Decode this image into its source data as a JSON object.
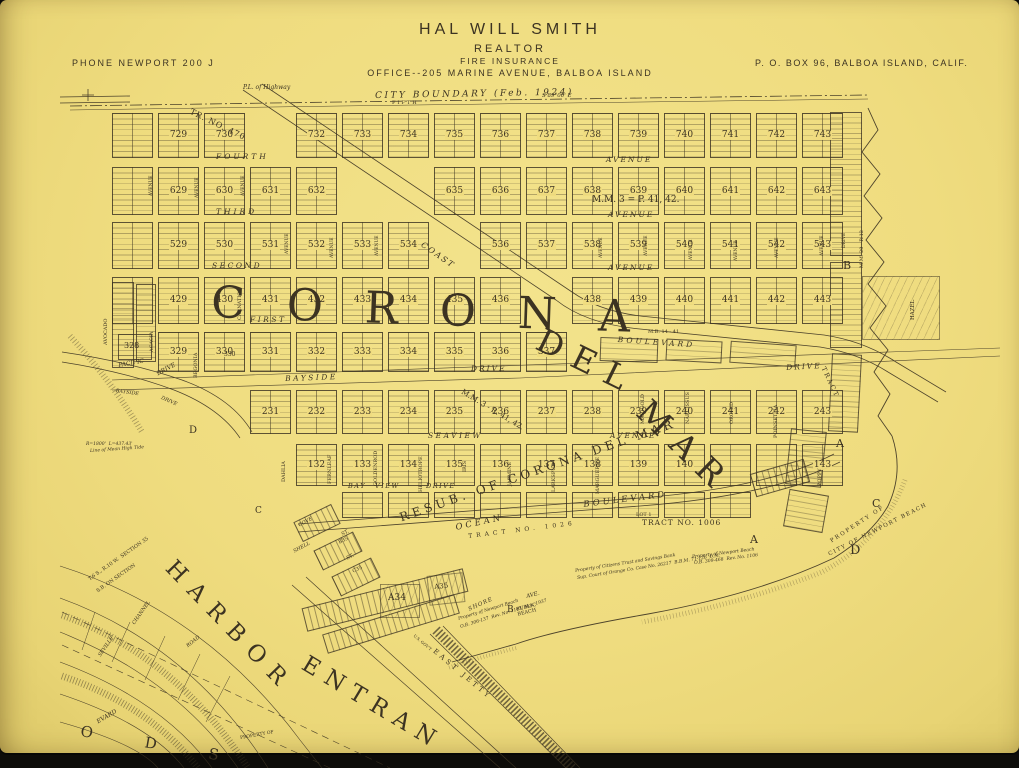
{
  "colors": {
    "paper": "#efdc7f",
    "ink": "#3c3322"
  },
  "header": {
    "title": "HAL WILL SMITH",
    "subtitle": "REALTOR",
    "line3": "FIRE INSURANCE",
    "office": "OFFICE--205 MARINE AVENUE, BALBOA ISLAND",
    "phone": "PHONE NEWPORT 200 J",
    "po_box": "P. O. BOX 96, BALBOA ISLAND, CALIF."
  },
  "map": {
    "boundary": {
      "city_boundary": "CITY BOUNDARY (Feb. 1924)",
      "bearing": "S 89°00' E",
      "highway_note": "P.L. of Highway",
      "fifth": "FIFTH"
    },
    "big": {
      "corona": "CORONA",
      "del": "DEL",
      "mar": "MAR",
      "harbor": "HARBOR",
      "entrance": "ENTRAN",
      "resub": "RESUB. OF CORONA DEL MAR",
      "ods": "O D S"
    },
    "streets": {
      "fourth": "FOURTH",
      "third": "THIRD",
      "second": "SECOND",
      "first": "FIRST",
      "avenue": "AVENUE",
      "bayside": "BAYSIDE",
      "drive": "DRIVE",
      "seaview": "SEAVIEW",
      "bay": "BAY",
      "view": "VIEW",
      "ocean": "OCEAN",
      "boulevard": "BOULEVARD",
      "coast": "COAST",
      "pacific": "PACIFIC",
      "shore": "SHORE",
      "ave": "AVE.",
      "cove": "COVE",
      "st": "ST.",
      "shell": "SHELL",
      "channel": "CHANNEL",
      "road": "ROAD",
      "seville": "SEVILLE",
      "boulevard_frag": "EVARD",
      "east_jetty": "EAST JETTY",
      "vertical": [
        "AVOCADO",
        "ACACIA",
        "BEGONIA",
        "CARNATION",
        "DAHLIA",
        "FERNLEAF",
        "GOLDENROD",
        "HELIOTROPE",
        "IRIS",
        "JASMINE",
        "LARKSPUR",
        "MARGUERITE",
        "MARIGOLD",
        "NARCISSUS",
        "ORCHID",
        "POINSETTIA",
        "POPPY",
        "HAZEL"
      ]
    },
    "tracts": {
      "tr470": "TR. NO. 470",
      "mm3p": "M.M. 3 = P. 41, 42.",
      "mm3r": "M.M. 3 - R. 41, 42.",
      "lot1": "LOT 1",
      "tract1006": "TRACT NO. 1006",
      "tract1026": "TRACT NO. 1026",
      "mm20r12": "M.M. 20 - R.12",
      "tract_frag": "TRACT",
      "mb14": "M.B. 14 - 41"
    },
    "annotations": {
      "public_beach": "PUBLIC BEACH",
      "prop_nb1": "Property of Newport Beach",
      "prop_nb1b": "O.B. 306-137  Rev. No. 1163  Nov. 1937",
      "prop_cit1": "Property of Citizens Trust and Savings Bank",
      "prop_cit2": "Sup. Court of Orange Co. Case No. 26217  B.B.M. 71-126  D.M.",
      "prop_nb2": "Property of Newport Beach",
      "prop_nb2b": "O.B. 309-468  Rev. No. 1106",
      "property_of": "PROPERTY OF",
      "city_of_nb": "CITY OF NEWPORT BEACH",
      "us_govt": "U.S. GOV'T",
      "section1": "T.6 S., R.10 W.  SECTION 35",
      "section2": "S.B. ON SECTION",
      "radius": "R=1800'  L=437.43'",
      "tide": "Line of Mean High Tide",
      "property_of2": "PROPERTY OF"
    },
    "markers": {
      "a1": "A",
      "a2": "A",
      "b1": "B",
      "b2": "B",
      "c1": "C",
      "c2": "C",
      "d1": "D",
      "d2": "D",
      "a34": "A34",
      "a35": "A35",
      "b35": "B35",
      "c35": "C35",
      "block328": "328",
      "n330": "330"
    },
    "block_rows": [
      {
        "name": "row-700s",
        "cells": [
          "#",
          "729",
          "730",
          "",
          "732",
          "733",
          "734",
          "735",
          "736",
          "737",
          "738",
          "739",
          "740",
          "741",
          "742",
          "743"
        ]
      },
      {
        "name": "row-600s",
        "cells": [
          "#",
          "629",
          "630",
          "631",
          "632",
          "",
          "",
          "635",
          "636",
          "637",
          "638",
          "639",
          "640",
          "641",
          "642",
          "643"
        ]
      },
      {
        "name": "row-500s",
        "cells": [
          "#",
          "529",
          "530",
          "531",
          "532",
          "533",
          "534",
          "",
          "536",
          "537",
          "538",
          "539",
          "540",
          "541",
          "542",
          "543"
        ]
      },
      {
        "name": "row-400s",
        "cells": [
          "#",
          "429",
          "430",
          "431",
          "432",
          "433",
          "434",
          "435",
          "436",
          "",
          "438",
          "439",
          "440",
          "441",
          "442",
          "443"
        ]
      },
      {
        "name": "row-300s",
        "cells": [
          "329",
          "330",
          "331",
          "332",
          "333",
          "334",
          "335",
          "336",
          "337"
        ]
      },
      {
        "name": "row-200s",
        "cells": [
          "231",
          "232",
          "233",
          "234",
          "235",
          "236",
          "237",
          "238",
          "239",
          "240",
          "241",
          "242",
          "243"
        ]
      },
      {
        "name": "row-100s",
        "cells": [
          "132",
          "133",
          "134",
          "135",
          "136",
          "137",
          "138",
          "139",
          "140",
          "#",
          "#",
          "143"
        ]
      },
      {
        "name": "row-ocean-front",
        "cells": [
          "#",
          "#",
          "#",
          "#",
          "#",
          "#",
          "#",
          "#",
          "#"
        ]
      }
    ]
  }
}
